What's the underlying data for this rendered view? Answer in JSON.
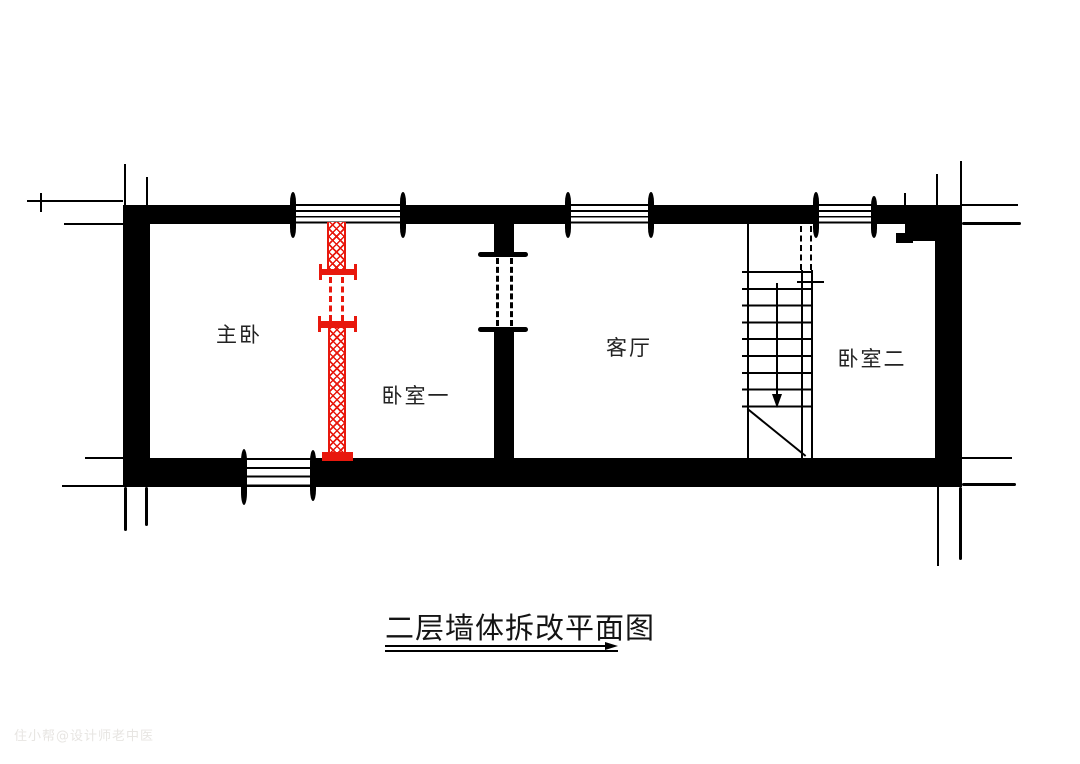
{
  "title": {
    "text": "二层墙体拆改平面图"
  },
  "watermark": {
    "text": "住小帮@设计师老中医"
  },
  "rooms": [
    {
      "name": "master-bedroom",
      "label": "主卧"
    },
    {
      "name": "bedroom-one",
      "label": "卧室一"
    },
    {
      "name": "living-room",
      "label": "客厅"
    },
    {
      "name": "bedroom-two",
      "label": "卧室二"
    }
  ],
  "stairs": {
    "tread_count": 9,
    "direction_arrow": "down"
  },
  "openings": {
    "top_windows": 3,
    "bottom_windows": 1,
    "dashed_door_openings": 2
  },
  "colors": {
    "wall": "#000000",
    "modified_wall": "#e8180d",
    "text": "#222222",
    "watermark": "#e7e5e2"
  }
}
